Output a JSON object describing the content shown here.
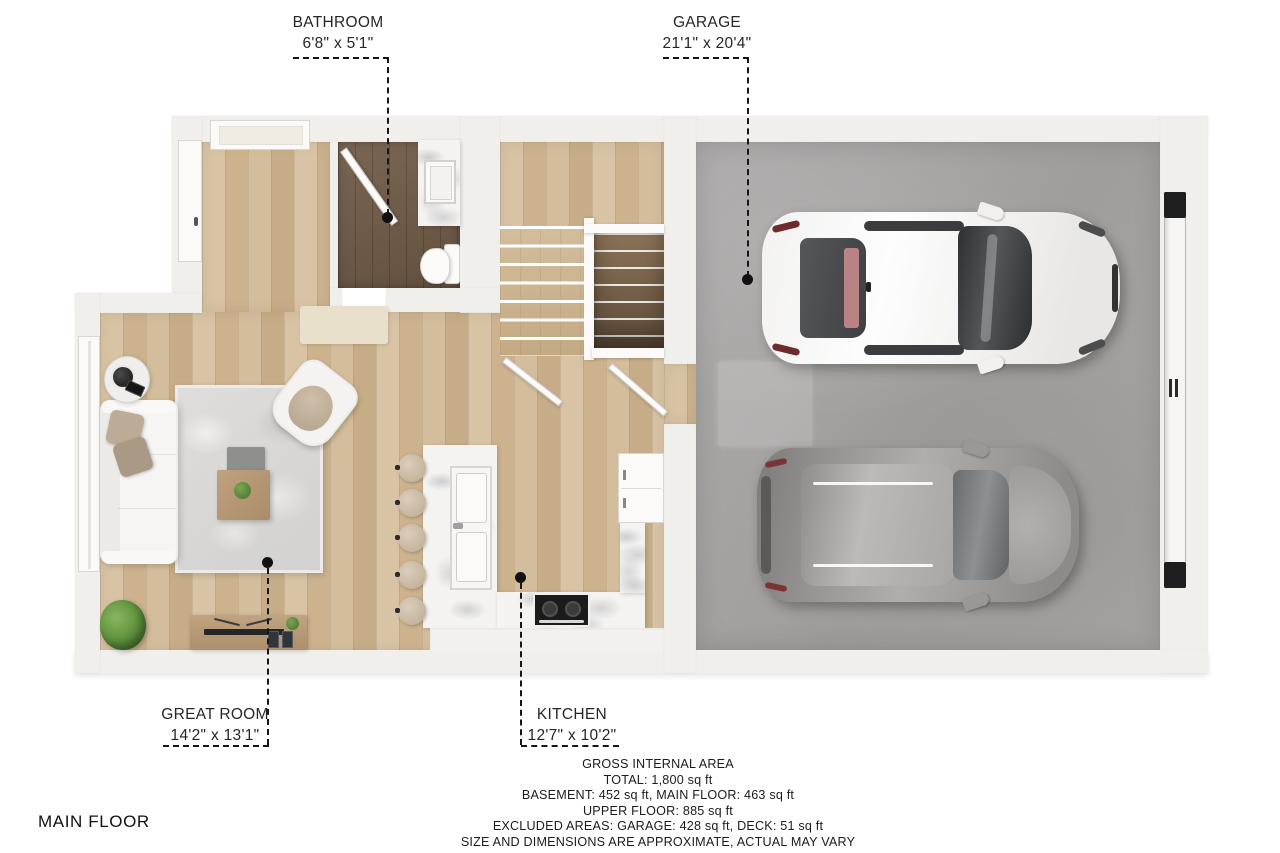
{
  "floor_title": "MAIN FLOOR",
  "rooms": {
    "bathroom": {
      "label": "BATHROOM",
      "dimensions": "6'8\" x 5'1\""
    },
    "garage": {
      "label": "GARAGE",
      "dimensions": "21'1\" x 20'4\""
    },
    "great_room": {
      "label": "GREAT ROOM",
      "dimensions": "14'2\" x 13'1\""
    },
    "kitchen": {
      "label": "KITCHEN",
      "dimensions": "12'7\" x 10'2\""
    }
  },
  "area_summary": {
    "heading": "GROSS INTERNAL AREA",
    "total": "TOTAL: 1,800 sq ft",
    "basement_and_main": "BASEMENT: 452 sq ft, MAIN FLOOR: 463 sq ft",
    "upper": "UPPER FLOOR: 885 sq ft",
    "excluded": "EXCLUDED AREAS: GARAGE: 428 sq ft, DECK: 51 sq ft",
    "disclaimer": "SIZE AND DIMENSIONS ARE APPROXIMATE, ACTUAL MAY VARY"
  },
  "colors": {
    "background": "#ffffff",
    "wall": "#f1efec",
    "wood_floor": "#d2bb97",
    "bathroom_floor": "#6f5b49",
    "garage_floor": "#a6a4a2",
    "marble": "#f4f3f1",
    "rug": "#dcdbd9",
    "leader_line": "#161616",
    "text": "#222222"
  }
}
